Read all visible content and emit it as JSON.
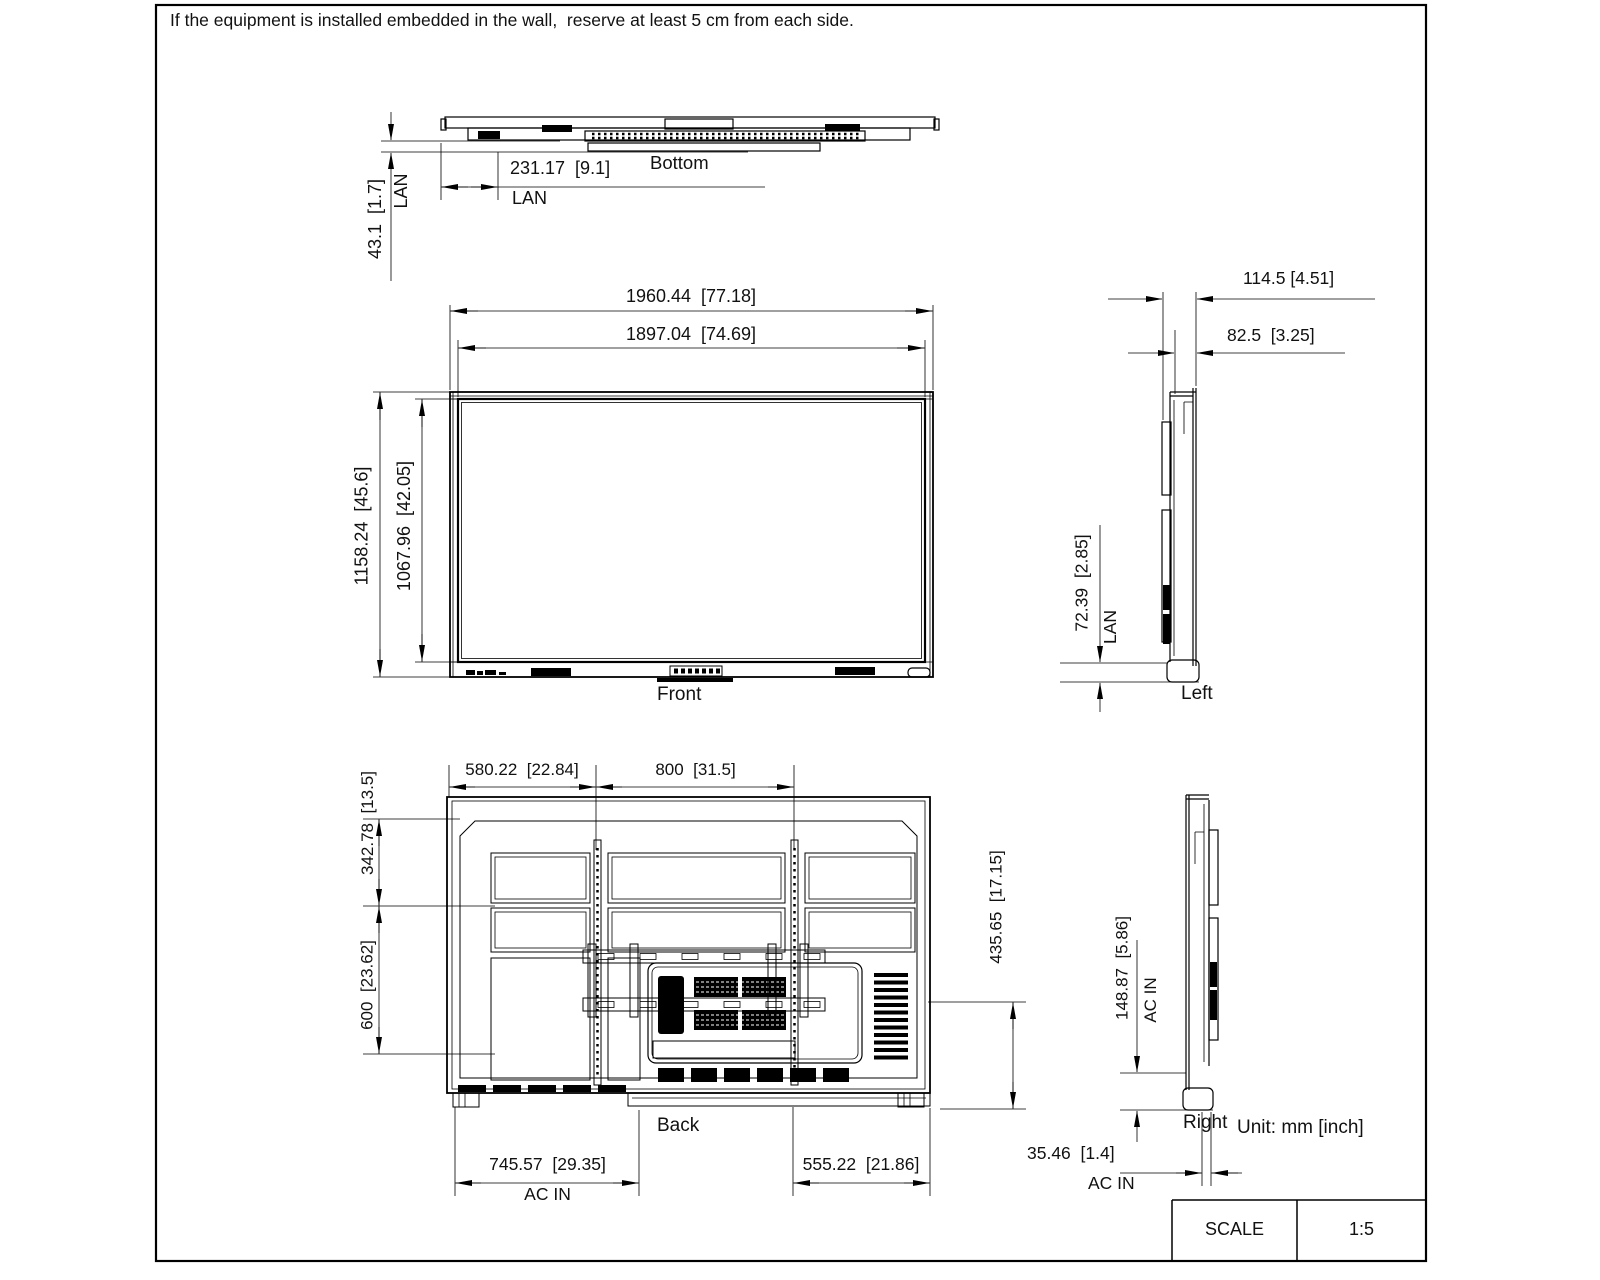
{
  "note": "If the equipment is installed embedded in the wall,  reserve at least 5 cm from each side.",
  "unit_label": "Unit: mm [inch]",
  "scale": {
    "label": "SCALE",
    "value": "1:5"
  },
  "views": {
    "bottom": {
      "label": "Bottom",
      "lan_offset": "231.17  [9.1]",
      "lan_offset_port": "LAN",
      "lan_height": "43.1  [1.7]",
      "lan_height_port": "LAN"
    },
    "front": {
      "label": "Front",
      "outer_width": "1960.44  [77.18]",
      "screen_width": "1897.04  [74.69]",
      "outer_height": "1158.24  [45.6]",
      "screen_height": "1067.96  [42.05]"
    },
    "left": {
      "label": "Left",
      "total_depth": "114.5 [4.51]",
      "body_depth": "82.5  [3.25]",
      "lan_height": "72.39  [2.85]",
      "lan_port": "LAN"
    },
    "back": {
      "label": "Back",
      "vesa_offset_left": "580.22  [22.84]",
      "vesa_width": "800  [31.5]",
      "vesa_offset_top": "342.78  [13.5]",
      "vesa_height": "600  [23.62]",
      "right_side_height": "435.65  [17.15]",
      "acin_offset_left": "745.57  [29.35]",
      "acin_port": "AC IN",
      "bottom_right_offset": "555.22  [21.86]"
    },
    "right": {
      "label": "Right",
      "acin_height": "148.87  [5.86]",
      "acin_height_port": "AC IN",
      "acin_depth": "35.46  [1.4]",
      "acin_depth_port": "AC IN"
    }
  }
}
